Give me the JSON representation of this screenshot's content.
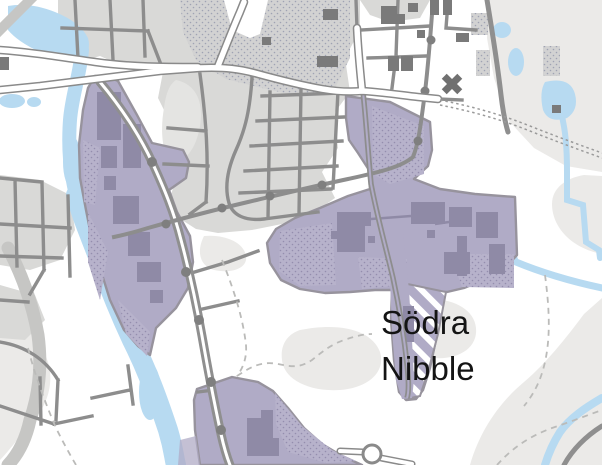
{
  "map": {
    "place_label": {
      "name": "Södra Nibble",
      "line1": "Södra",
      "line2": "Nibble"
    },
    "icons": {
      "church": "x-cross"
    },
    "colors": {
      "bg": "#ffffff",
      "terrain": "#ebeae8",
      "town": "#d9d9d7",
      "town_light": "#e4e4e2",
      "water": "#b7daf1",
      "zone_fill": "#b0abc6",
      "zone_border": "#97939d",
      "zone_bldg": "#8f8aa6",
      "zone_dot_base": "#b7b2cb",
      "zone_dot": "#948eae",
      "forest_base": "#d2d2d2",
      "forest_dot": "#9fa3b3",
      "building": "#7a7a7a",
      "road_casing": "#8a8a8a",
      "street": "#8d8d8d",
      "nsroad": "#8f8f8f",
      "node": "#7f7f7f",
      "wide_road": "#c6c6c4",
      "dash": "#bbbbb9",
      "boundary": "#9a9a9a",
      "hatch_stripe": "#ffffff",
      "label": "#141414",
      "church": "#707070"
    }
  }
}
